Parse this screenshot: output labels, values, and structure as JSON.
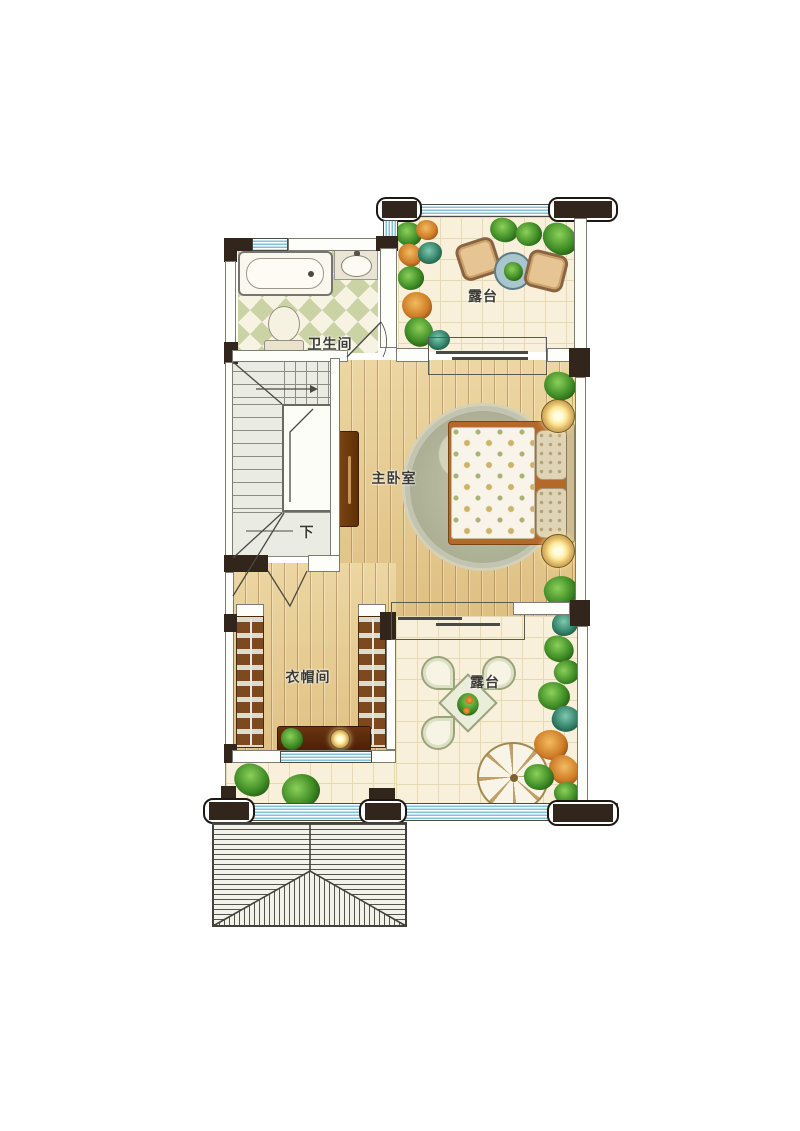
{
  "labels": {
    "terrace_top": "露台",
    "bathroom": "卫生间",
    "bedroom": "主卧室",
    "cloakroom": "衣帽间",
    "terrace_bottom": "露台",
    "stairs_down": "下"
  },
  "colors": {
    "wall_dark": "#32251c",
    "window_blue": "#7fc3dc",
    "wood_floor": "#e6ca92",
    "tile_floor": "#f8f0da",
    "bathroom_tile_green": "#cbd2a4",
    "stair_floor": "#eaece3",
    "rug": "#b2b49a",
    "wardrobe_brown": "#7c4a1e",
    "plant_green": "#3f8c26",
    "accent_orange": "#cd7a24"
  }
}
